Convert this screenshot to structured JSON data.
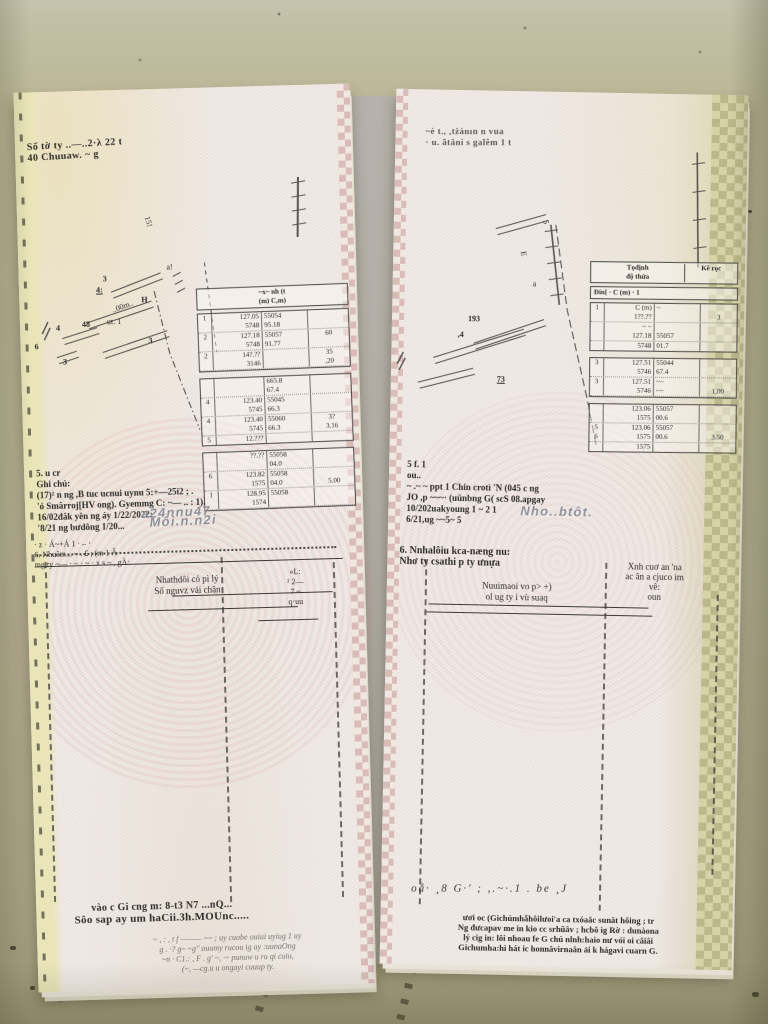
{
  "colors": {
    "floor": "#b4b092",
    "paper": "#f0ebe7",
    "yellow_edge_band": "#e9e5b9",
    "green_edge_band": "#d6d3a8",
    "checker_pink": "#c69694",
    "watermark_gray": "#7f818b",
    "ink": "#2d2b29"
  },
  "left_doc": {
    "header_lines": [
      "Số tờ ty ..―..2·λ 22 t",
      "40 Chuuaw. ~ g"
    ],
    "sketch_labels": [
      "3",
      "4:",
      "4",
      "48",
      "ut. 1",
      "..00m..",
      "6",
      "3",
      "3",
      "H",
      "15!",
      "a!"
    ],
    "table": {
      "header_lines": [
        "~x~   nh (t",
        "(m)    C,m)"
      ],
      "groups": [
        {
          "rows": [
            [
              "1",
              "127.05",
              "55054",
              ""
            ],
            [
              "",
              "5748",
              "95.18",
              ""
            ],
            [
              "2",
              "127.18",
              "55057",
              "60"
            ],
            [
              "",
              "5748",
              "91.77",
              ""
            ],
            [
              "2",
              "14?.??",
              "",
              "35"
            ],
            [
              "",
              "3146",
              "",
              ",20"
            ]
          ]
        },
        {
          "rows": [
            [
              "",
              "",
              "665.8",
              ""
            ],
            [
              "",
              "",
              "67.4",
              ""
            ],
            [
              "4",
              "123.40",
              "55045",
              ""
            ],
            [
              "",
              "5745",
              "66.3",
              ""
            ],
            [
              "4",
              "123.40",
              "55060",
              "3?"
            ],
            [
              "",
              "5745",
              "66.3",
              "3.16"
            ],
            [
              "5",
              "12.???",
              "",
              ""
            ]
          ]
        },
        {
          "rows": [
            [
              "",
              "??.??",
              "55058",
              ""
            ],
            [
              "",
              "",
              "04.0",
              ""
            ],
            [
              "6",
              "123.82",
              "55058",
              ""
            ],
            [
              "",
              "1575",
              "04.0",
              "5.00"
            ],
            [
              "1",
              "128.95",
              "55058",
              ""
            ],
            [
              "",
              "1574",
              "",
              ""
            ]
          ]
        }
      ]
    },
    "ghichu_lines": [
      "5. u cr",
      "Ghi chú:",
      "(17)² n ng ,B tuc ucnui uynu 5:+—25i2 ; .",
      "'ó Smărroj[HV ong). Gyemmg C: ~— .. : 1).",
      "16/02đắk yên ng áy 1/22/2022:",
      "'8/21 ng bưdông 1/20..."
    ],
    "watermark_lines": [
      "a24nnu47",
      "Môi.n.n2i"
    ],
    "section6_lines": [
      "· z ·    Á~+Á 1 · – ·",
      "6. Nhuăm... ~ . £ ;  (m 1 Â",
      "mg ty ~— ·  ~ ·  ~ ·   x s ~ ,  gÀ:"
    ],
    "sig_left_lines": [
      "Nhathdôi có pì lý",
      "Số nguvz vải chân"
    ],
    "sig_right_lines": [
      "«L:",
      "² 2—",
      "7 ~",
      "q·uu"
    ],
    "bottom_lines": [
      "vào c Gi cng m:  8-t3  N7 ...nQ...",
      "Sôo sap ay um haCii.3h.MOUnc....."
    ],
    "fineprint_lines": [
      "~ , : , t  f  ——— ~~ ;  uy cuobe ouiui uyiug 1 uy",
      "g . ·? g~ ~g''  ouumy rucou ig uy  :uunaOng",
      "~n · C1.: , F . g' ~, ·~ punuw u  ru  qi cuiu,",
      "(~, —cg.u u ongayi cuuup ty."
    ]
  },
  "right_doc": {
    "header_lines": [
      "~è t., ,tżánın n vua",
      "· u. ãtăni s galêm 1 t"
    ],
    "sketch_labels": [
      "193",
      ",4",
      "73",
      "E",
      "5",
      "a"
    ],
    "table": {
      "header_left_lines": [
        "Tọđịnh",
        "độ thửa"
      ],
      "header_right": "Kề rọc",
      "sub_lines": [
        "Đin[  ·  C (m)  ·  1"
      ],
      "groups": [
        {
          "rows": [
            [
              "1",
              "C (m)",
              "~",
              ""
            ],
            [
              "",
              "1??.??",
              "",
              "3"
            ],
            [
              "",
              "~ ~",
              "",
              ""
            ],
            [
              "",
              "127.18",
              "55057",
              ""
            ],
            [
              "",
              "5748",
              "01.7",
              ""
            ]
          ]
        },
        {
          "rows": [
            [
              "3",
              "127.51",
              "55044",
              ""
            ],
            [
              "",
              "5746",
              "67.4",
              ""
            ],
            [
              "3",
              "127.51",
              "~~",
              ""
            ],
            [
              "",
              "5746",
              "~~",
              "1,00"
            ]
          ]
        },
        {
          "rows": [
            [
              "",
              "123.06",
              "55057",
              ""
            ],
            [
              "",
              "1575",
              "00.6",
              ""
            ],
            [
              "5",
              "123.06",
              "55057",
              ""
            ],
            [
              "6",
              "1575",
              "00.6",
              "3.50"
            ],
            [
              "",
              "1575",
              "",
              ""
            ]
          ]
        }
      ]
    },
    "notes_lines": [
      "5 f. 1",
      "ou..",
      "~ .~ ~   ppt 1 Chin crotì 'N  (045 c ng",
      "JO ,p ~~~·   (uünbng G( scS 08.apgay",
      "10/202uakyoung 1 ~ 2 1",
      "6/21,ug  ~~5~ 5"
    ],
    "watermark_lines": [
      "Nho..btôt."
    ],
    "section6_lines": [
      "6. Nnhalôiu kca-næng nu:",
      "Nhơ ty csathi p ty ưnựa"
    ],
    "sig_left_lines": [
      "Nuuimaoi vo p> +)",
      "ol ug ty i vù suaq"
    ],
    "sig_right_lines": [
      "Xnh cuơ an 'na",
      "ac ân a cjuco im",
      "vê:",
      "oun"
    ],
    "scrawl": "oẵ· ¸8  G·' ; ,.~·.1 . be ¸J",
    "fineprint_lines": [
      "ươi oc (Gichúmhẫhôilưoi'a ca  txóaăc sunât hôing ; tr",
      "Ng đưcapav me in kio cc srhũâv ; hcbô ig Rờ : dunàona",
      "lý cig in: lôi nhoau fe G chú nlnh:haio nư vói oi câiâi",
      "Gichumha:hi hát ic honnâvirnaăn ải k hágavi cuarn G."
    ]
  }
}
